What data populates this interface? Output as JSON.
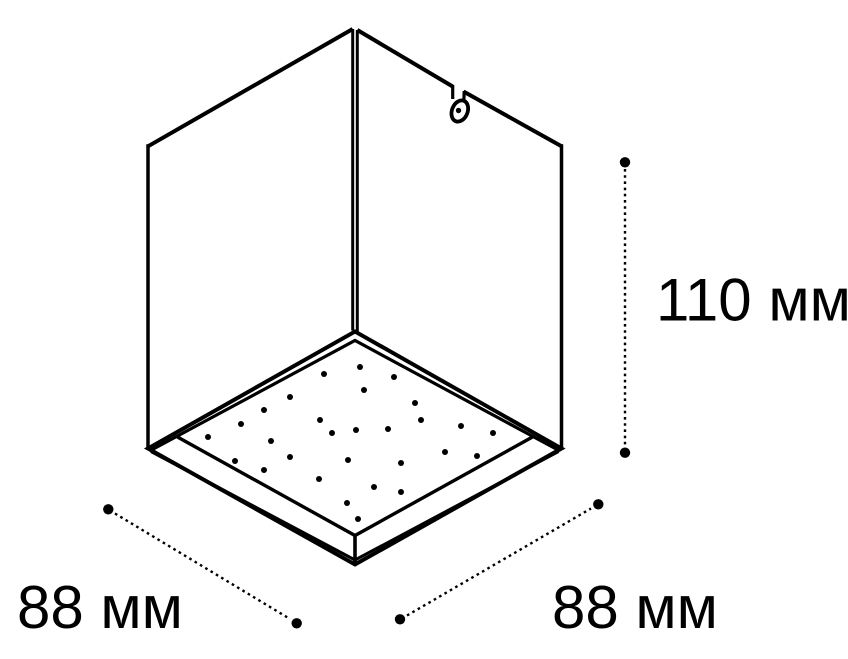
{
  "figure": {
    "object": "cube-downlight-technical-drawing",
    "background_color": "#ffffff",
    "line_color": "#000000"
  },
  "dimensions": {
    "height": {
      "value": 110,
      "unit": "мм",
      "label": "110 мм"
    },
    "base_left": {
      "value": 88,
      "unit": "мм",
      "label": "88 мм"
    },
    "base_right": {
      "value": 88,
      "unit": "мм",
      "label": "88 мм"
    }
  },
  "led_dot_radius": 3,
  "led_dots": [
    [
      360,
      367
    ],
    [
      324,
      374
    ],
    [
      394,
      377
    ],
    [
      364,
      390
    ],
    [
      290,
      397
    ],
    [
      415,
      403
    ],
    [
      264,
      410
    ],
    [
      320,
      420
    ],
    [
      421,
      420
    ],
    [
      241,
      424
    ],
    [
      461,
      426
    ],
    [
      388,
      429
    ],
    [
      356,
      430
    ],
    [
      332,
      433
    ],
    [
      493,
      433
    ],
    [
      208,
      437
    ],
    [
      271,
      441
    ],
    [
      445,
      452
    ],
    [
      477,
      456
    ],
    [
      290,
      457
    ],
    [
      348,
      460
    ],
    [
      235,
      461
    ],
    [
      401,
      463
    ],
    [
      264,
      470
    ],
    [
      319,
      479
    ],
    [
      374,
      487
    ],
    [
      401,
      492
    ],
    [
      347,
      503
    ],
    [
      358,
      519
    ]
  ]
}
